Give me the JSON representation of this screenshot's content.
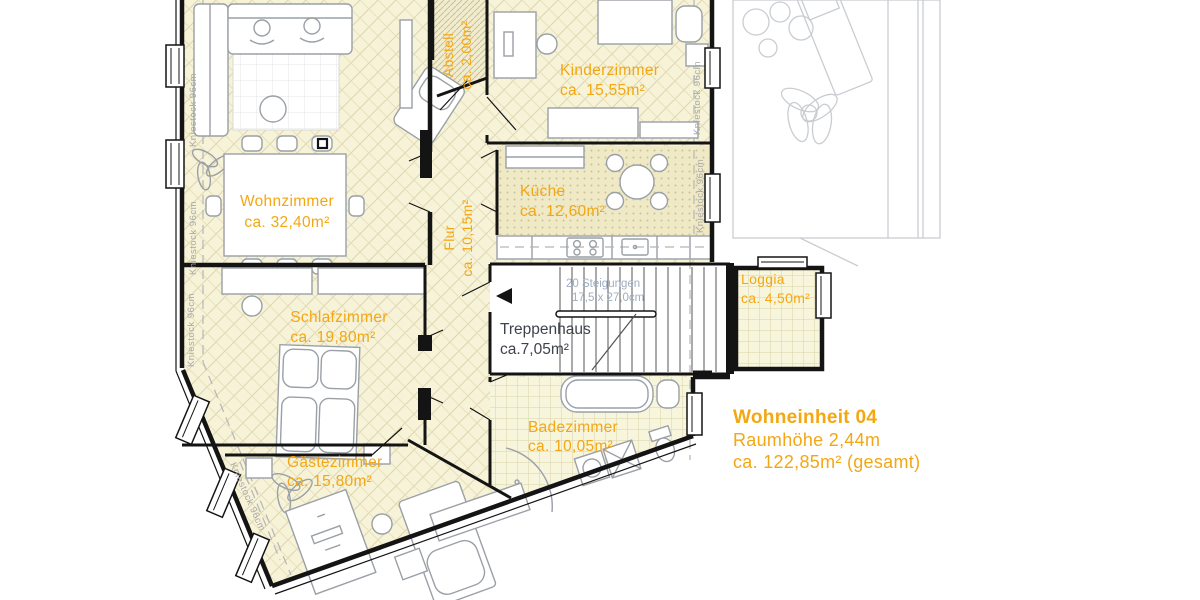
{
  "unit_info": {
    "title": "Wohneinheit 04",
    "ceiling_height": "Raumhöhe 2,44m",
    "total_area": "ca. 122,85m² (gesamt)"
  },
  "rooms": {
    "wohnzimmer": {
      "name": "Wohnzimmer",
      "area": "ca. 32,40m²"
    },
    "kinderzimmer": {
      "name": "Kinderzimmer",
      "area": "ca. 15,55m²"
    },
    "kueche": {
      "name": "Küche",
      "area": "ca. 12,60m²"
    },
    "schlafzimmer": {
      "name": "Schlafzimmer",
      "area": "ca. 19,80m²"
    },
    "gaestezimmer": {
      "name": "Gästezimmer",
      "area": "ca. 15,80m²"
    },
    "badezimmer": {
      "name": "Badezimmer",
      "area": "ca. 10,05m²"
    },
    "flur": {
      "name": "Flur",
      "area": "ca. 10,15m²"
    },
    "abstell": {
      "name": "Abstell",
      "area": "ca. 2,00m²"
    },
    "treppenhaus": {
      "name": "Treppenhaus",
      "area": "ca.7,05m²"
    },
    "loggia": {
      "name": "Loggia",
      "area": "ca. 4,50m²"
    }
  },
  "stairs_note": {
    "line1": "20 Steigungen",
    "line2": "17,5 x 27,0cm"
  },
  "annotations": {
    "kniestock": "Kniestock 96cm"
  },
  "colors": {
    "accent": "#F3A712",
    "floor": "#F6F3D9",
    "floor_kitchen": "#EFE9C6",
    "floor_bath": "#F8F5DD",
    "wall": "#141414",
    "furniture": "#9AA0A6",
    "neighbor": "#C9CDD1",
    "trep_text": "#3E434C",
    "stair_text": "#9FAEC2",
    "kniestock_text": "#A8A8A8"
  }
}
